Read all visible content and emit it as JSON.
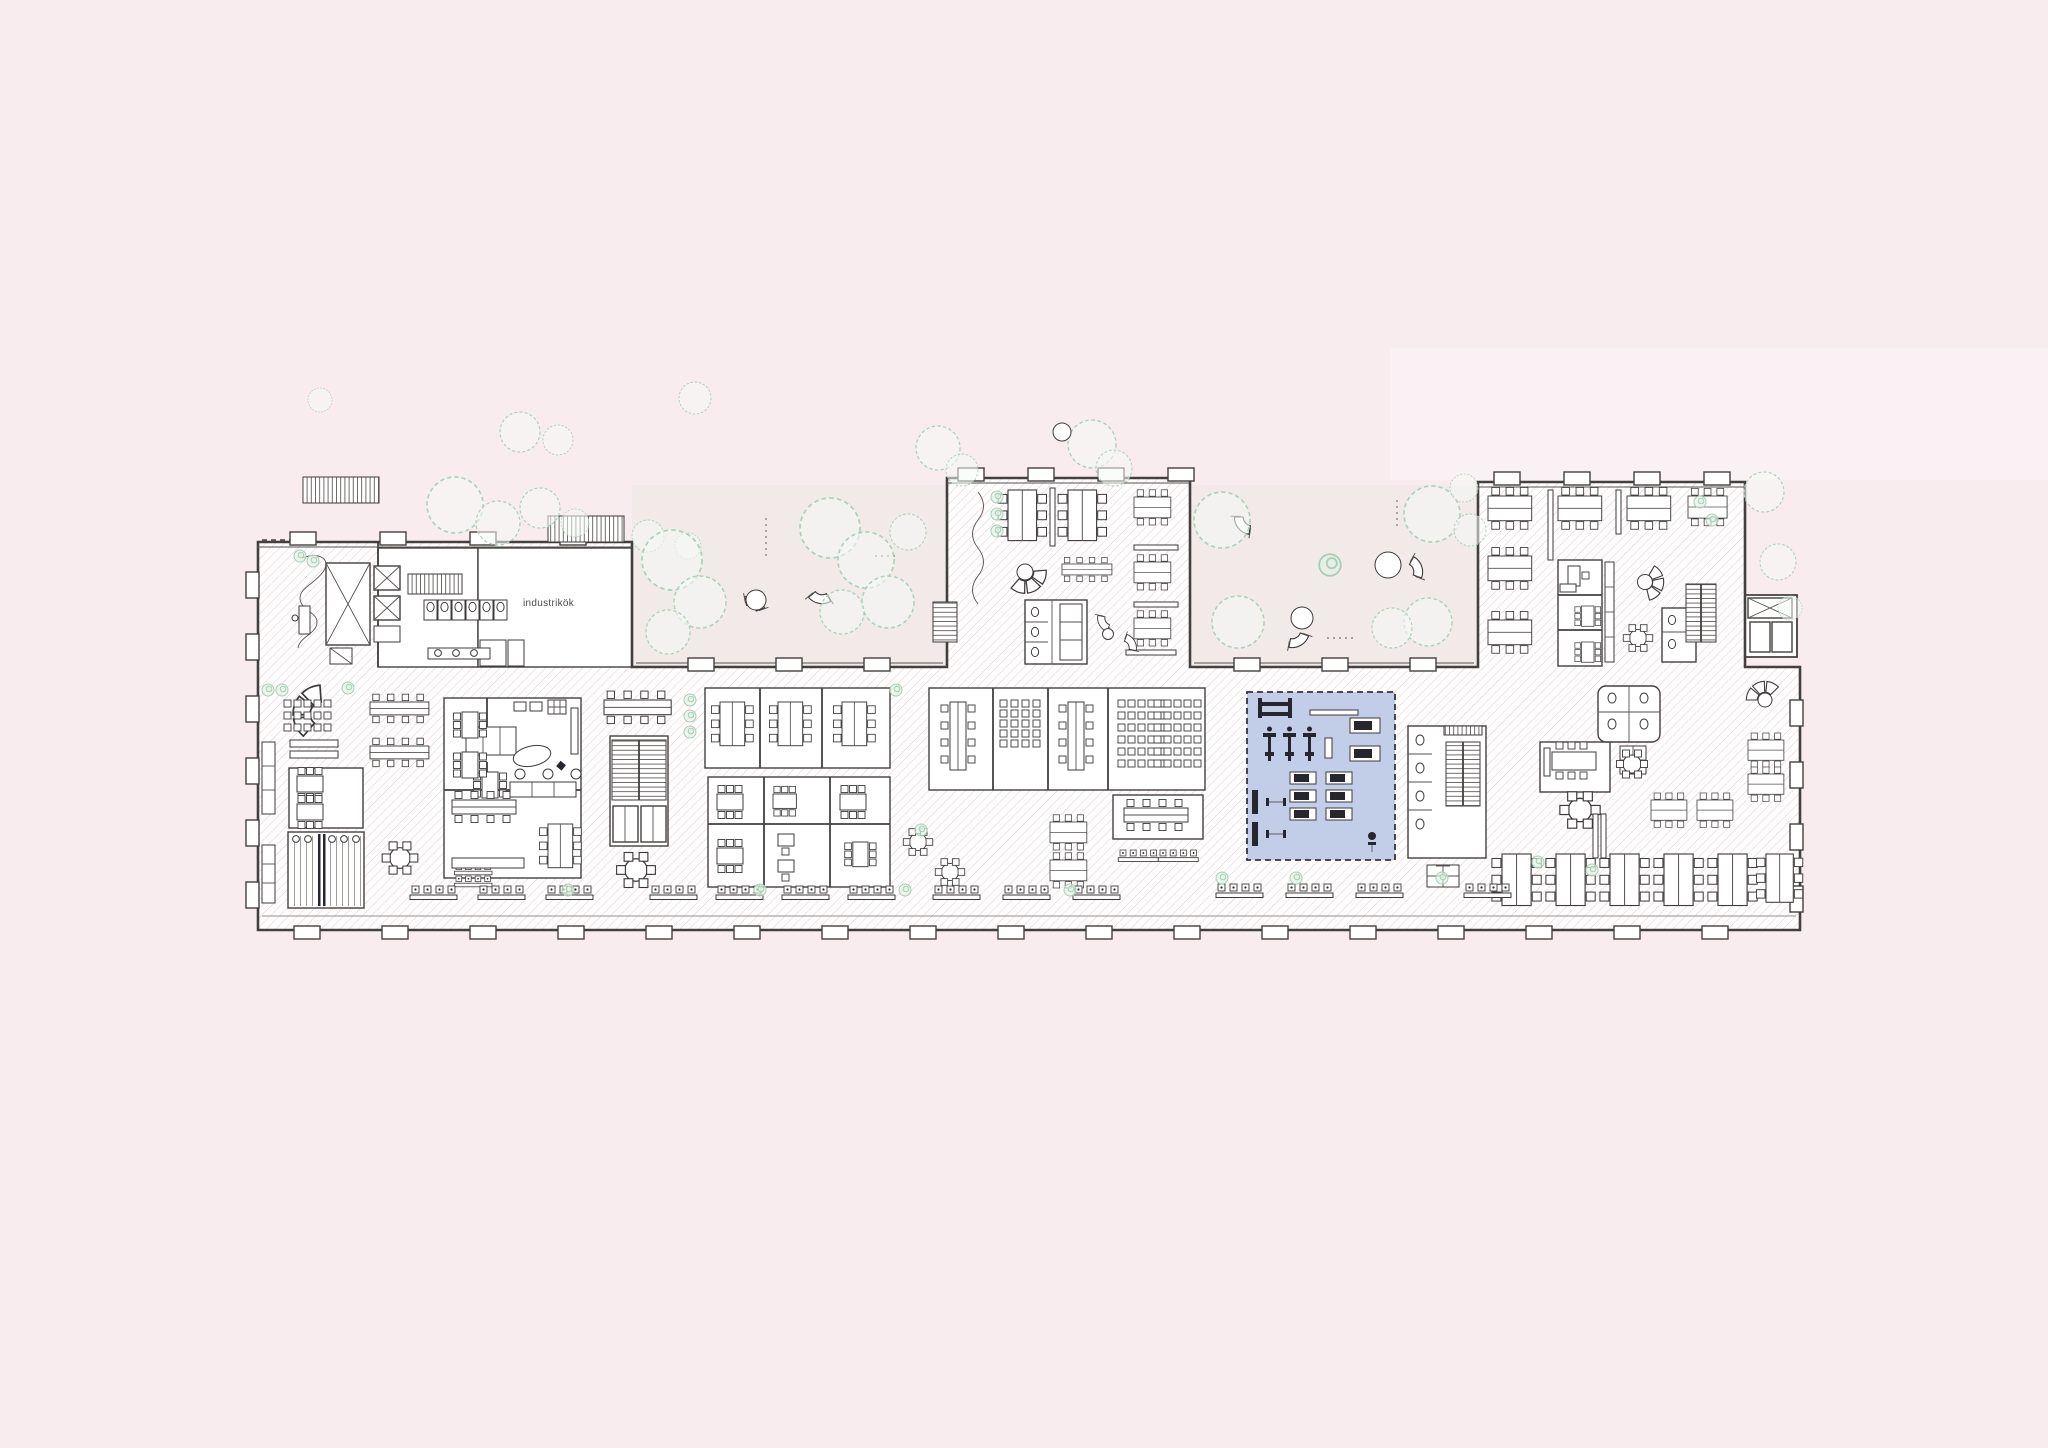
{
  "plan": {
    "type": "architectural-floor-plan",
    "labels": {
      "industrial_kitchen": "industrikök"
    },
    "colors": {
      "background": "#f8ecef",
      "courtyard": "#f2e9e9",
      "top_band": "#fbf4f6",
      "hatch_line": "#eac0c9",
      "wall": "#43403f",
      "room_white": "#ffffff",
      "room_yellow": "#f1ebc3",
      "room_beige": "#d8d0c6",
      "room_blue": "#c2cee8",
      "room_red": "#d3a19b",
      "room_cream": "#f3edca",
      "tree_stroke": "#abd3b8",
      "equipment_dark": "#26262e"
    },
    "rooms": [
      {
        "id": "entrance-lobby",
        "zone": "left-wing"
      },
      {
        "id": "industrial-kitchen",
        "zone": "left-wing",
        "label": "industrikök",
        "fill": "#ffffff"
      },
      {
        "id": "restrooms-left-wing",
        "zone": "left-wing"
      },
      {
        "id": "workshop-yellow-large",
        "zone": "main-band",
        "fill": "#f1ebc3"
      },
      {
        "id": "workshop-yellow-small",
        "zone": "main-band",
        "fill": "#f1ebc3"
      },
      {
        "id": "wardrobe-curtain-room",
        "zone": "main-band"
      },
      {
        "id": "meeting-cluster-beige",
        "zone": "main-band",
        "fill": "#d8d0c6"
      },
      {
        "id": "lecture-complex-beige",
        "zone": "main-band",
        "fill": "#d8d0c6"
      },
      {
        "id": "conference-beige",
        "zone": "main-band",
        "fill": "#d8d0c6"
      },
      {
        "id": "gym-blue",
        "zone": "main-band",
        "fill": "#c2cee8"
      },
      {
        "id": "focus-rooms-red",
        "zone": "right-wing",
        "fill": "#d3a19b"
      },
      {
        "id": "open-office-center-wing",
        "zone": "center-wing"
      },
      {
        "id": "open-office-right-wing",
        "zone": "right-wing"
      },
      {
        "id": "storage-cream",
        "zone": "main-band",
        "fill": "#f3edca"
      }
    ]
  }
}
